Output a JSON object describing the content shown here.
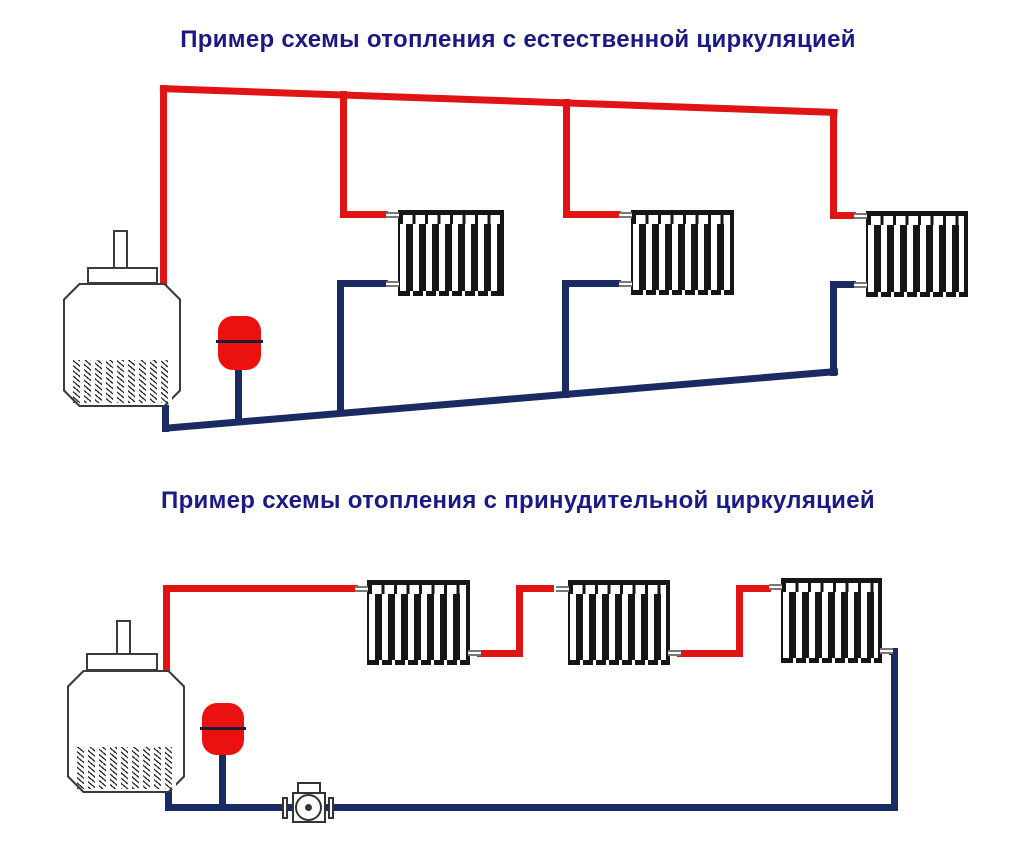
{
  "sections": [
    {
      "id": "natural",
      "title": "Пример схемы отопления с естественной циркуляцией"
    },
    {
      "id": "forced",
      "title": "Пример схемы отопления с принудительной циркуляцией"
    }
  ],
  "colors": {
    "supply": "#e01414",
    "return": "#1a2a63",
    "title": "#1a1a86",
    "outline": "#3b3b3b",
    "tank": "#ec1111",
    "background": "#ffffff"
  }
}
